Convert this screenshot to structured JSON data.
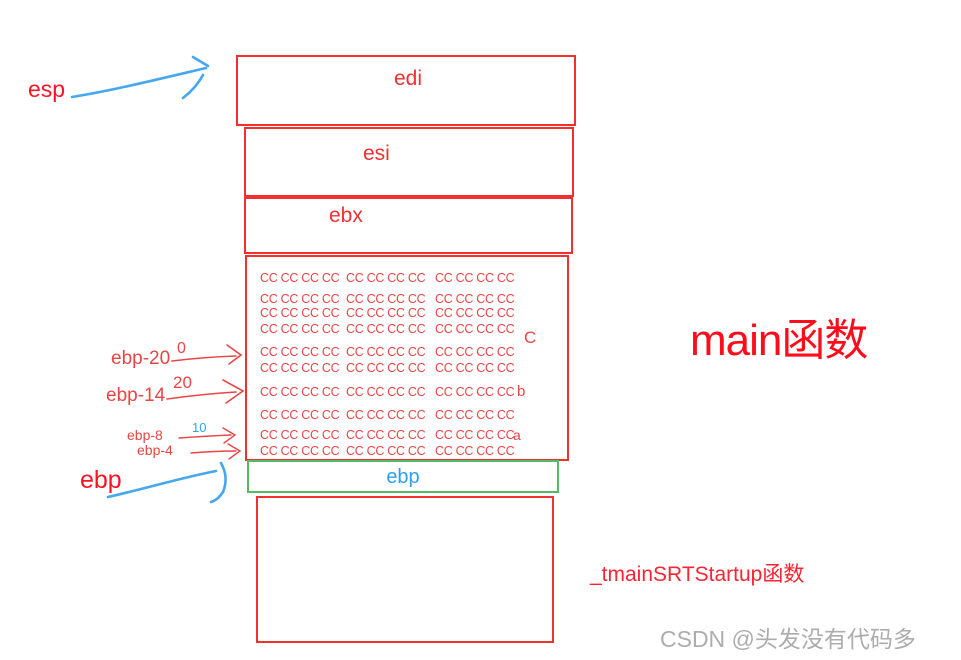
{
  "pointers": {
    "esp": "esp",
    "ebp": "ebp"
  },
  "registers": [
    {
      "name": "edi"
    },
    {
      "name": "esi"
    },
    {
      "name": "ebx"
    }
  ],
  "saved_ebp": {
    "label": "ebp"
  },
  "offsets": [
    {
      "label": "ebp-20",
      "value": "0"
    },
    {
      "label": "ebp-14",
      "value": "20"
    },
    {
      "label": "ebp-8",
      "value": "10"
    },
    {
      "label": "ebp-4",
      "value": ""
    }
  ],
  "buffer": {
    "fill_group": "CC CC CC CC",
    "markers": {
      "c": "C",
      "b": "b",
      "a": "a"
    }
  },
  "annotations": {
    "main_function": "main函数",
    "startup_function": "_tmainSRTStartup函数",
    "watermark": "CSDN @头发没有代码多"
  },
  "colors": {
    "box_red": "#f23030",
    "cc_red": "#e84545",
    "arrow_blue": "#45a7ee",
    "ebp_green": "#55b965",
    "watermark_gray": "#adadad"
  }
}
